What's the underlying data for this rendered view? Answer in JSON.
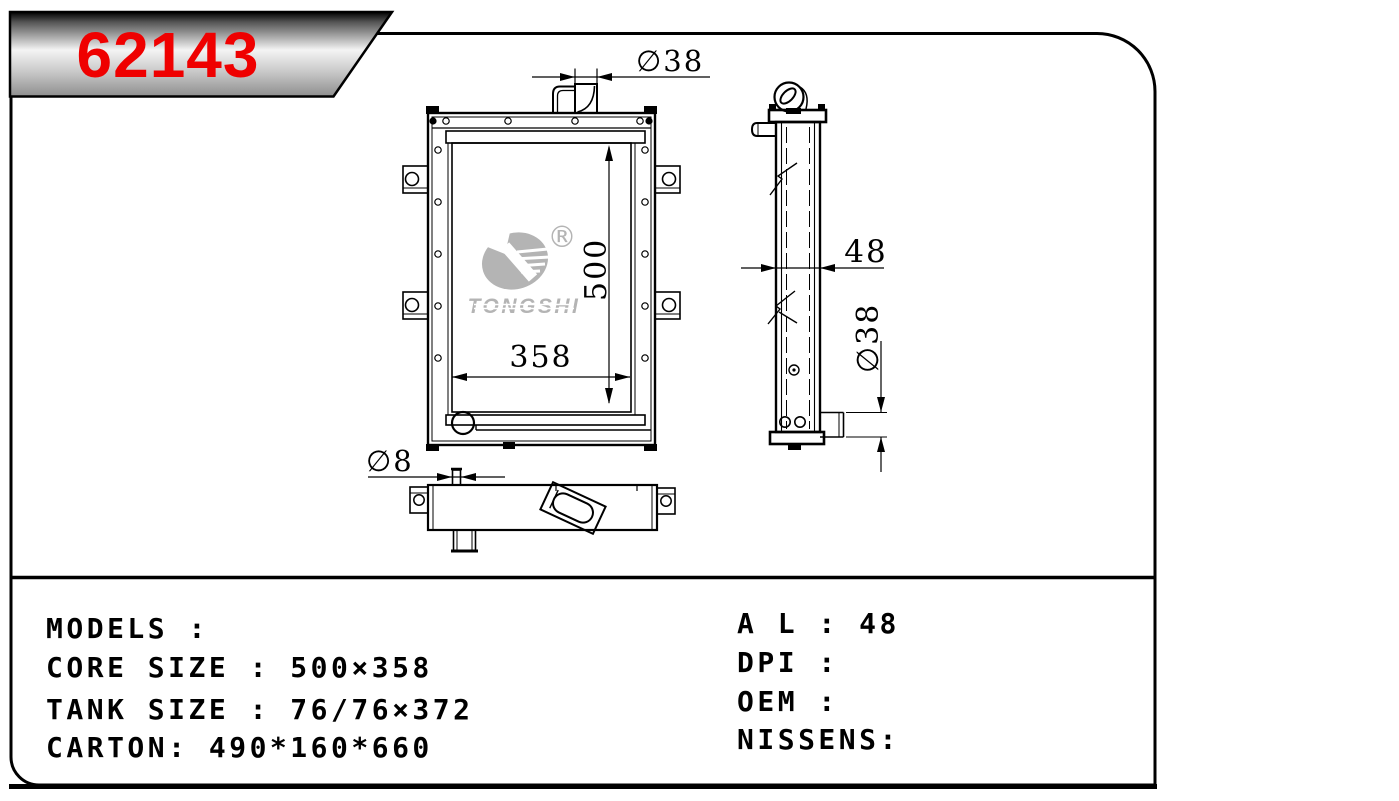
{
  "banner": {
    "part_number": "62143"
  },
  "logo": {
    "brand": "TONGSHI",
    "registered": "®"
  },
  "drawing": {
    "front_view": {
      "height_dim": "500",
      "width_dim": "358",
      "filler_neck_dim": "∅38"
    },
    "side_view": {
      "width_dim": "48",
      "outlet_pipe_dim": "∅38"
    },
    "bottom_view": {
      "drain_pin_dim": "∅8"
    }
  },
  "specs": {
    "models": "MODELS :",
    "core_size": "CORE SIZE : 500×358",
    "tank_size": "TANK SIZE : 76/76×372",
    "carton": "CARTON: 490*160*660",
    "al": "A L : 48",
    "dpi": "DPI :",
    "oem": "OEM :",
    "nissens": "NISSENS:"
  },
  "colors": {
    "background": "#ffffff",
    "line": "#000000",
    "part_number_red": "#ef0000",
    "watermark_gray": "#b4b4b4"
  }
}
